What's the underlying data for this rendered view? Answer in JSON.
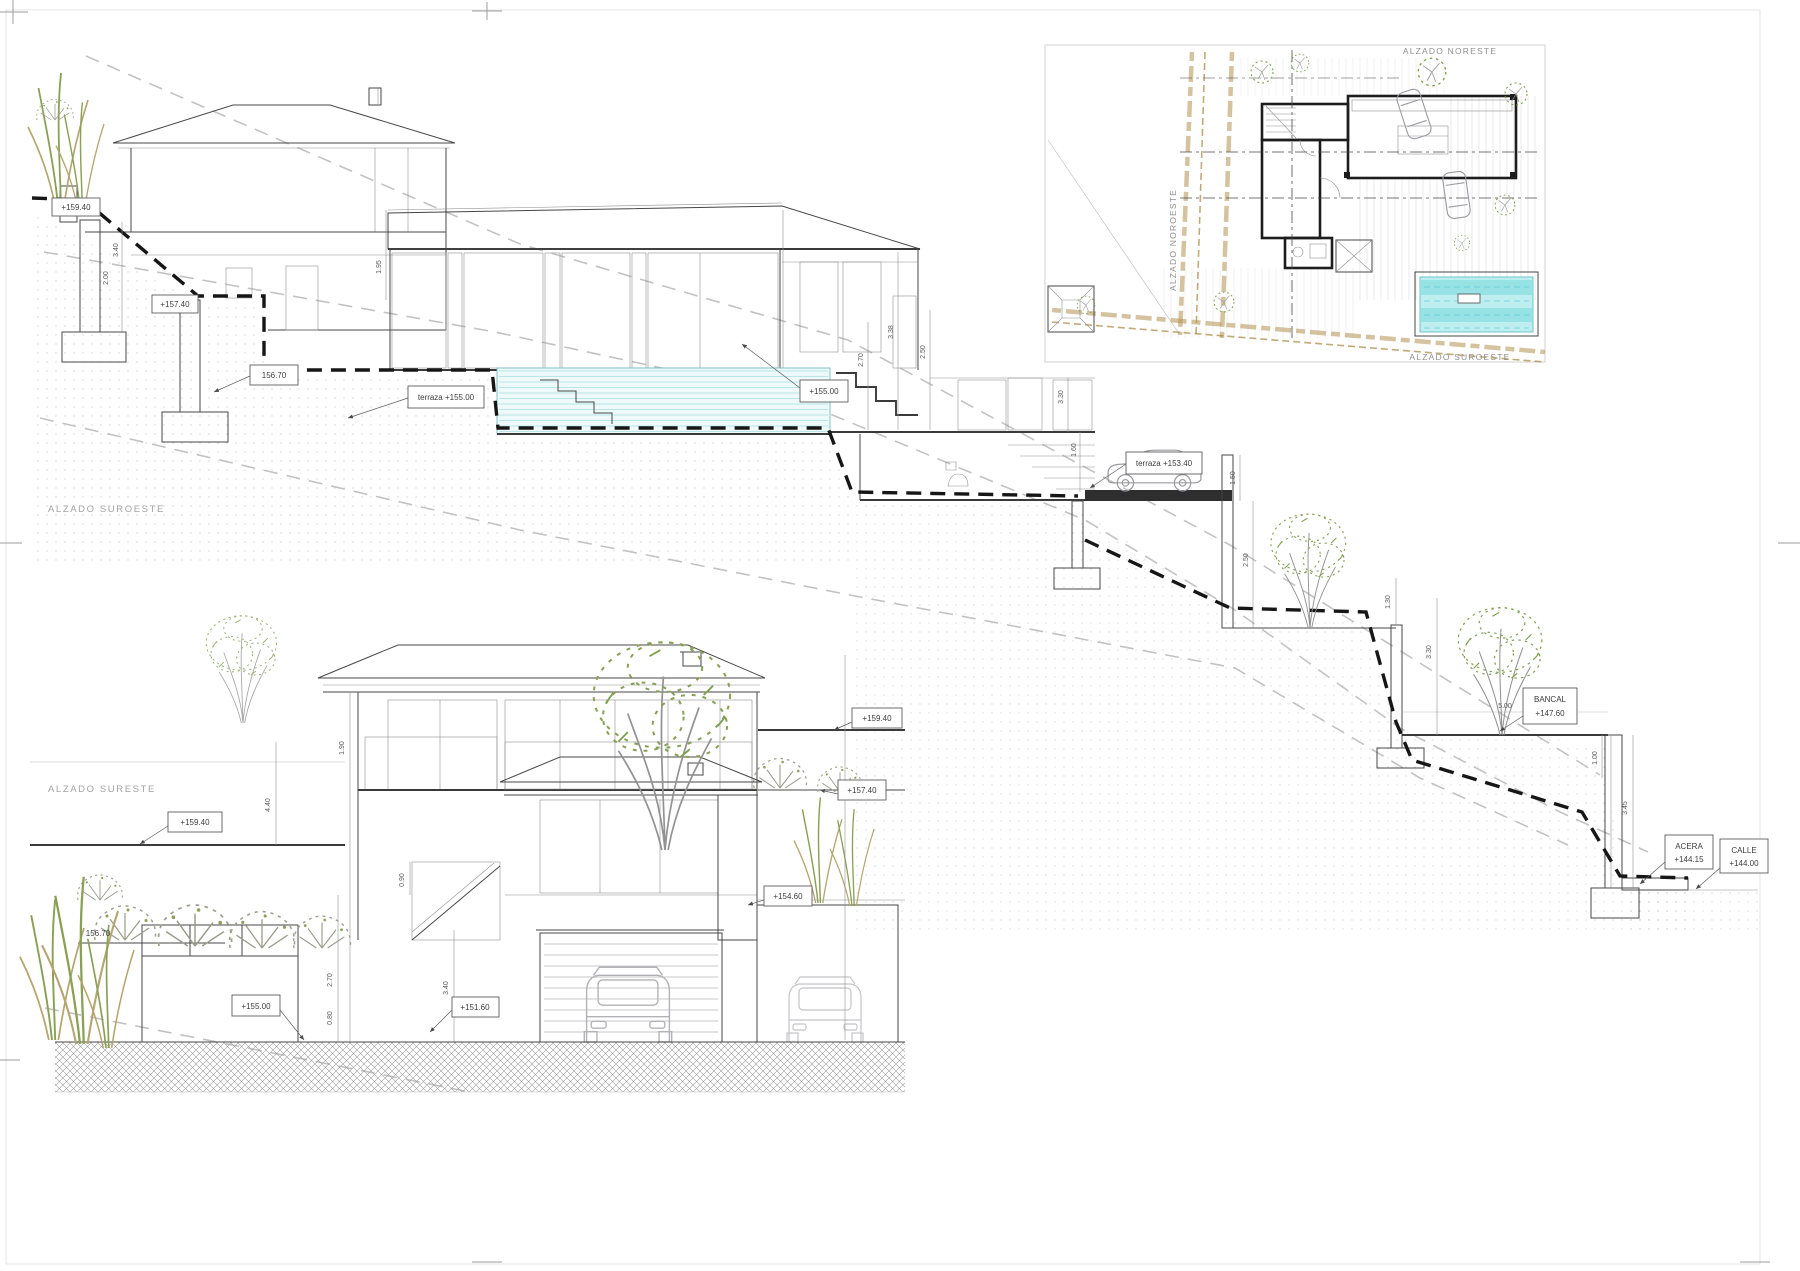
{
  "sheet": {
    "background": "#ffffff"
  },
  "colors": {
    "pool_fill": "#bfeef0",
    "pool_stripe": "#8adde2",
    "boundary_tan": "#b3904f",
    "foliage_green": "#86a055"
  },
  "section_sw": {
    "title": "ALZADO SUROESTE",
    "levels": {
      "l1": "+159.40",
      "l2": "+157.40",
      "l3": "156.70",
      "l4": "terraza +155.00",
      "l5": "+155.00",
      "l6": "terraza +153.40",
      "l7": "+151.60"
    },
    "street": {
      "bancal": {
        "l1": "BANCAL",
        "l2": "+147.60"
      },
      "acera": {
        "l1": "ACERA",
        "l2": "+144.15"
      },
      "calle": {
        "l1": "CALLE",
        "l2": "+144.00"
      }
    },
    "dims": {
      "d1": "3.40",
      "d2": "2.00",
      "d3": "1.95",
      "d4": "3.38",
      "d5": "2.70",
      "d6": "2.50",
      "d7": "3.30",
      "d8": "1.60",
      "d9": "1.50",
      "d10": "2.50",
      "d11": "1.30",
      "d12": "3.30",
      "d13": "5.00",
      "d14": "1.00",
      "d15": "3.45"
    }
  },
  "elevation_se": {
    "title": "ALZADO SURESTE",
    "levels": {
      "left_top": "+159.40",
      "left_mid": "156.70",
      "left_low": "+155.00",
      "right_top": "+159.40",
      "right_mid": "+157.40",
      "right_low": "+154.60",
      "garage": "+151.60"
    },
    "dims": {
      "d1": "4.40",
      "d2": "1.90",
      "d3": "0.90",
      "d4": "2.70",
      "d5": "0.80",
      "d6": "3.40"
    }
  },
  "site_plan": {
    "label_top": "ALZADO NORESTE",
    "label_left": "ALZADO NOROESTE",
    "label_bottom": "ALZADO SUROESTE"
  }
}
